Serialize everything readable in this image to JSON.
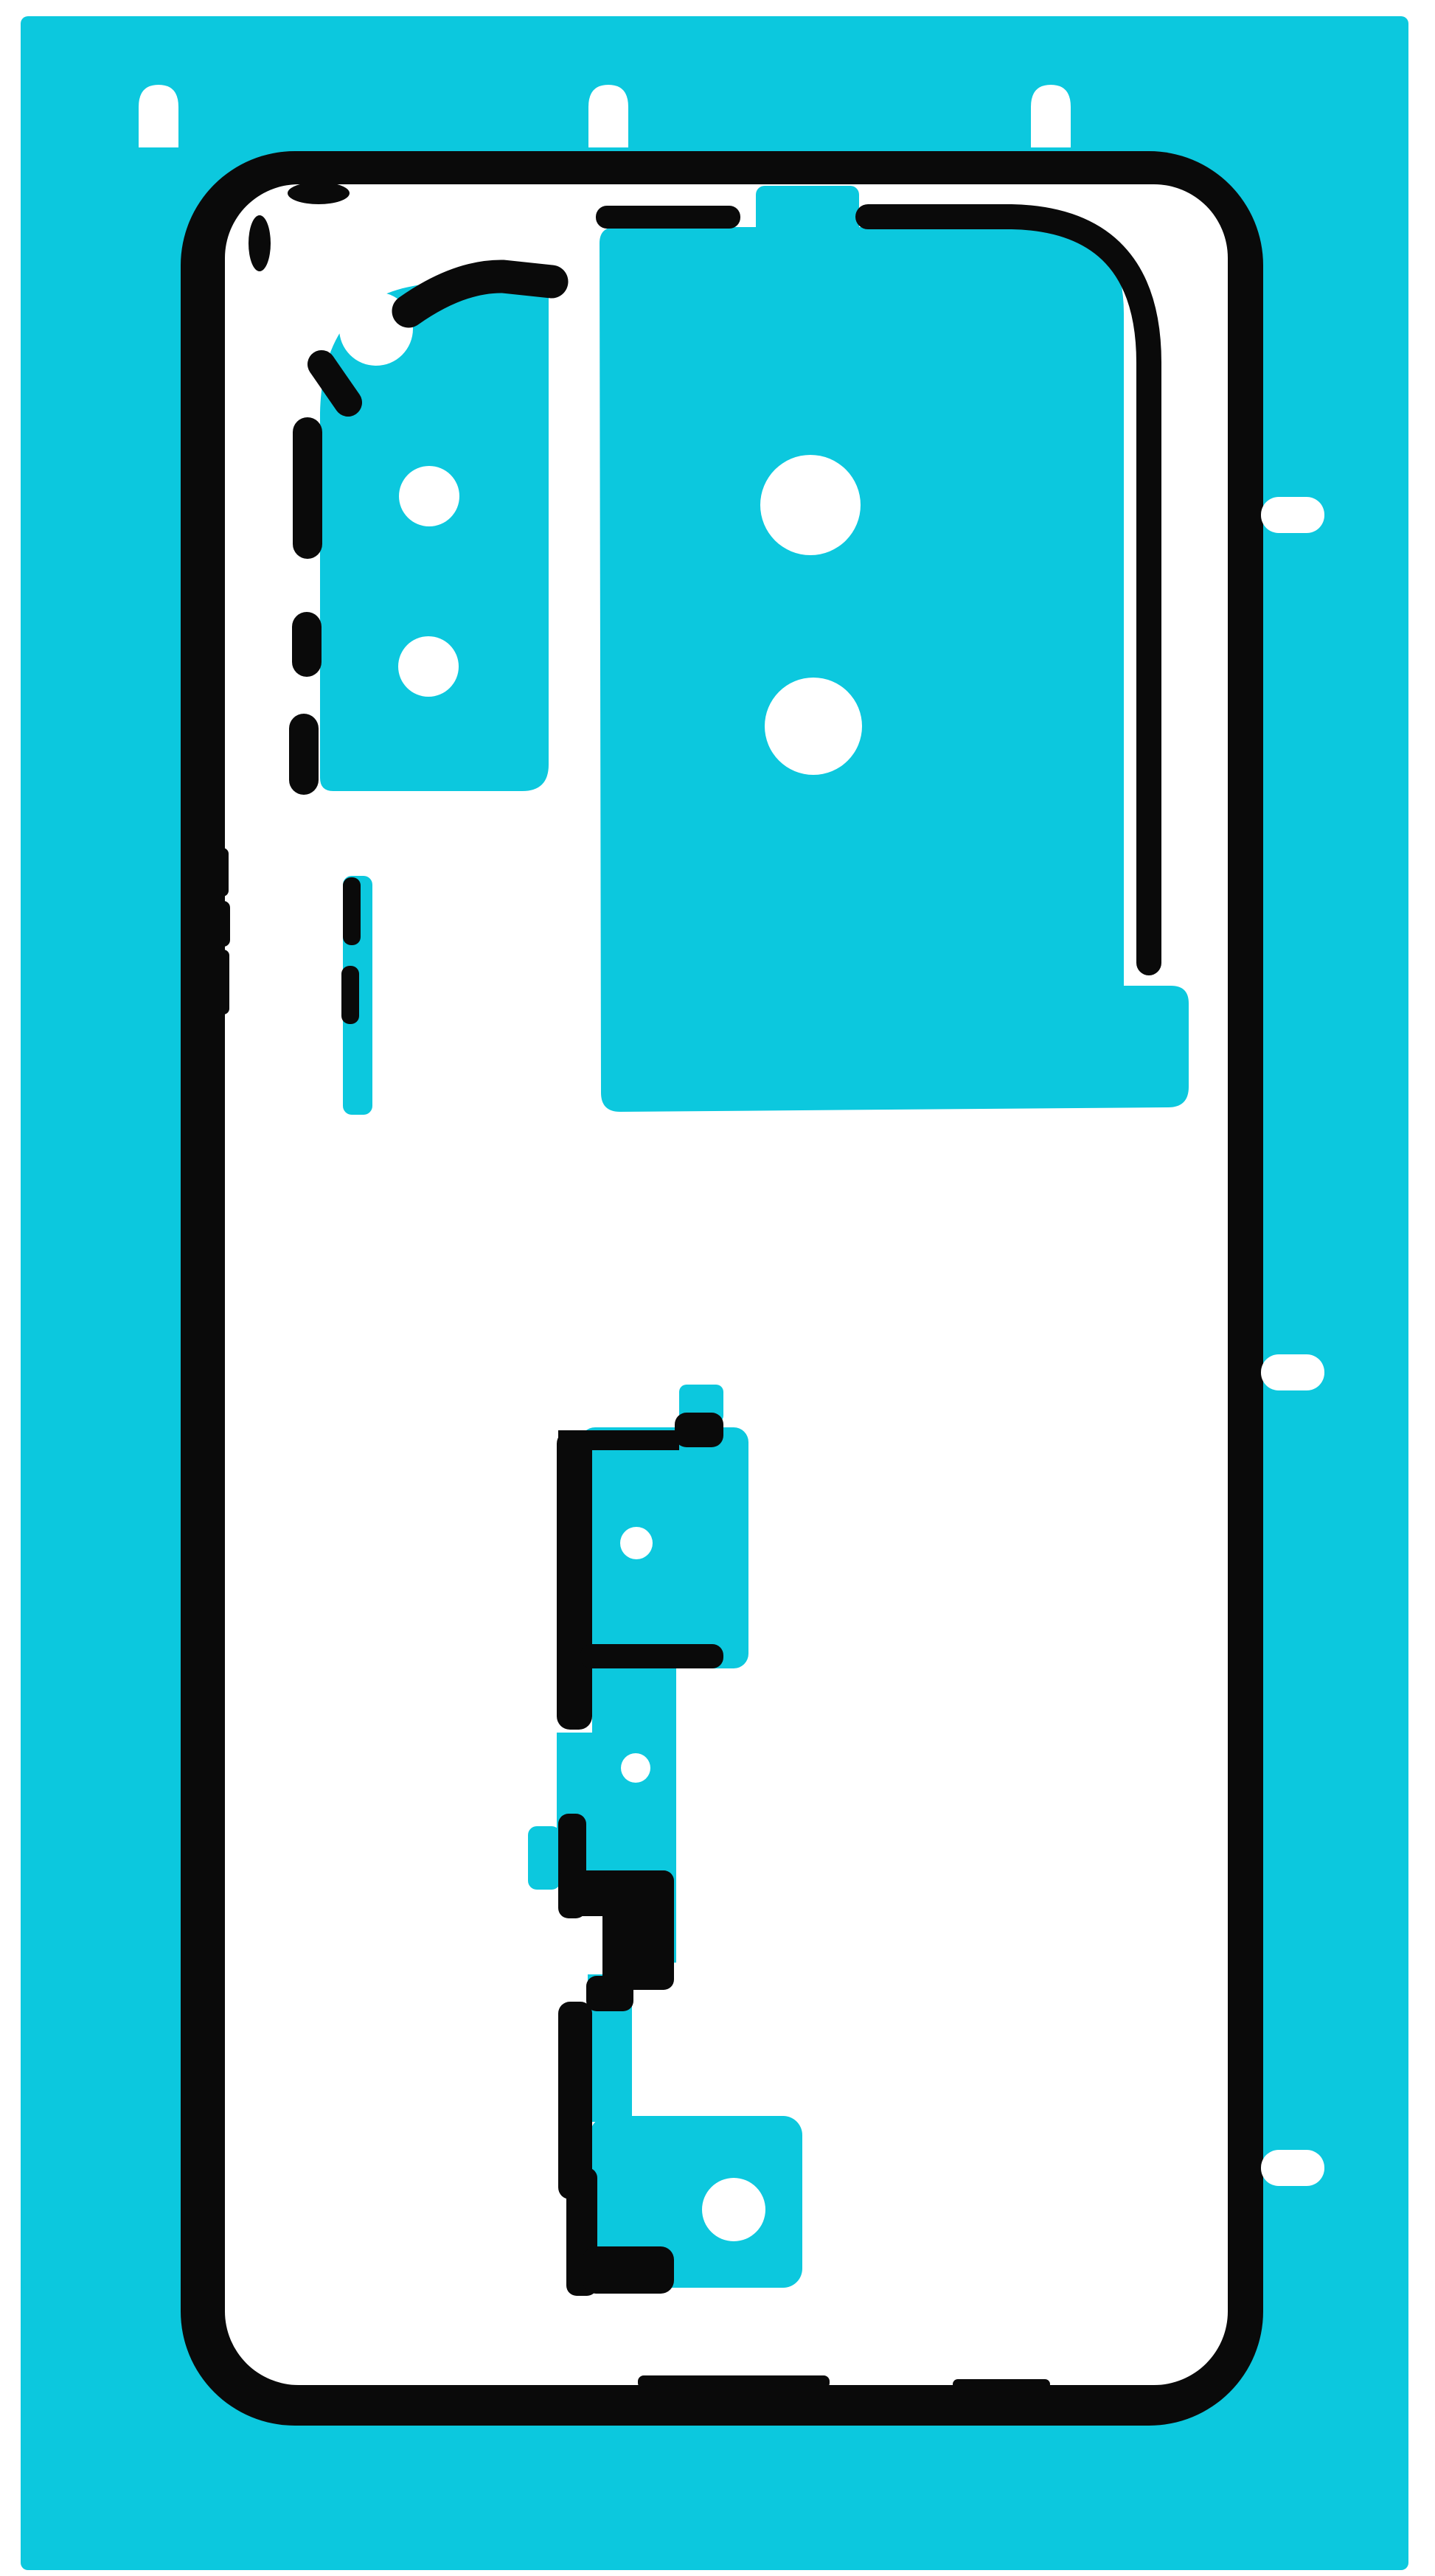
{
  "image": {
    "description": "Die-cut adhesive sticker sheet for a smartphone back cover on a cyan liner",
    "orientation": "portrait"
  },
  "colors": {
    "page": "#ffffff",
    "sheet": "#0cc8de",
    "ink": "#0a0a0a",
    "interior": "#ffffff",
    "hole": "#ffffff"
  },
  "parts": {
    "sheet": "adhesive liner sheet",
    "cover_outline": "phone back cover perimeter adhesive",
    "camera_zone": "rear camera adhesive pad",
    "camera_zone_holes": 2,
    "main_lens_zone": "large lens/glass adhesive pad",
    "main_lens_zone_holes": 2,
    "side_strip": "side rail adhesive strip",
    "fingerprint_zone_holes": 3,
    "registration_tabs_top": 3,
    "pull_tabs_right": 3
  }
}
